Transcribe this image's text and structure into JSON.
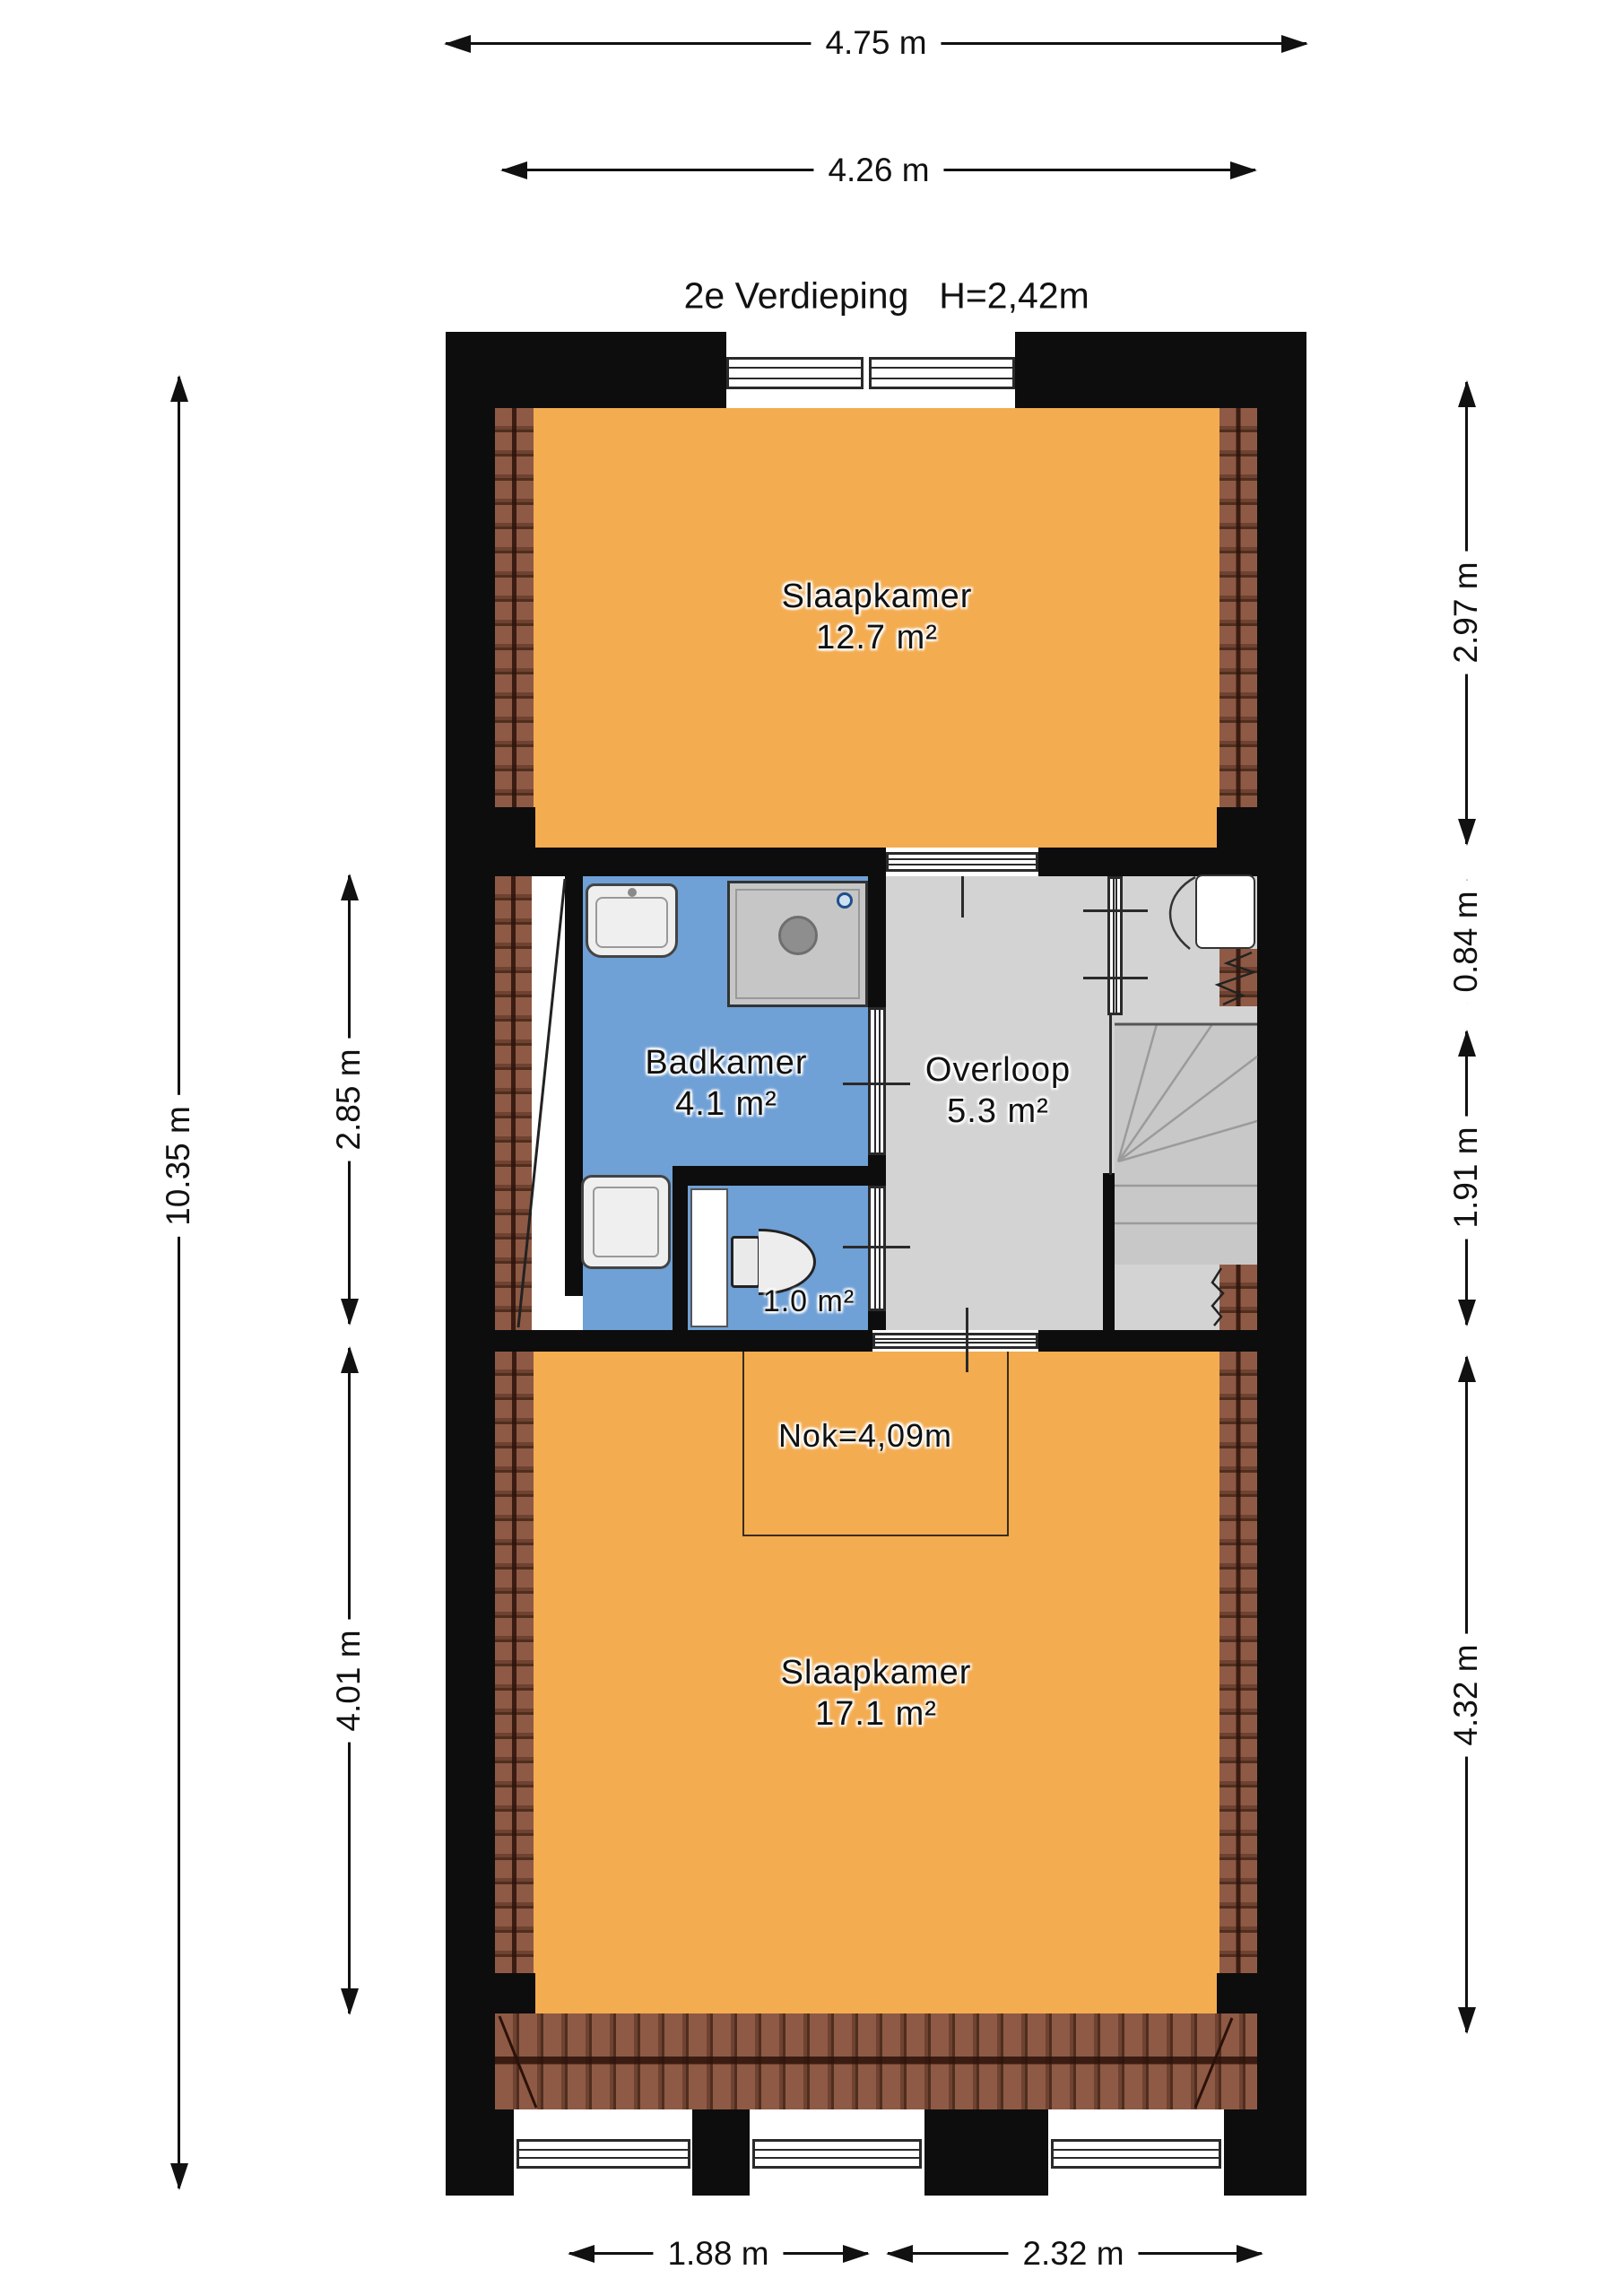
{
  "title": {
    "floor_label": "2e Verdieping",
    "ceiling_height": "H=2,42m"
  },
  "dimensions": {
    "top_outer": "4.75 m",
    "top_inner": "4.26 m",
    "left_total": "10.35 m",
    "left_middle": "2.85 m",
    "left_bottom": "4.01 m",
    "right_top": "2.97 m",
    "right_upper_mid": "0.84 m",
    "right_lower_mid": "1.91 m",
    "right_bottom": "4.32 m",
    "bottom_left": "1.88 m",
    "bottom_right": "2.32 m"
  },
  "rooms": {
    "bedroom_top": {
      "name": "Slaapkamer",
      "area": "12.7 m²"
    },
    "bathroom": {
      "name": "Badkamer",
      "area": "4.1 m²"
    },
    "landing": {
      "name": "Overloop",
      "area": "5.3 m²"
    },
    "toilet": {
      "area": "1.0 m²"
    },
    "bedroom_bottom": {
      "name": "Slaapkamer",
      "area": "17.1 m²"
    }
  },
  "annotations": {
    "ridge_height": "Nok=4,09m"
  },
  "colors": {
    "room_orange": "#F3AC50",
    "room_blue": "#6FA0D6",
    "room_gray": "#D3D3D3",
    "wall_black": "#0D0D0D",
    "roof_tile": "#8A5743"
  }
}
